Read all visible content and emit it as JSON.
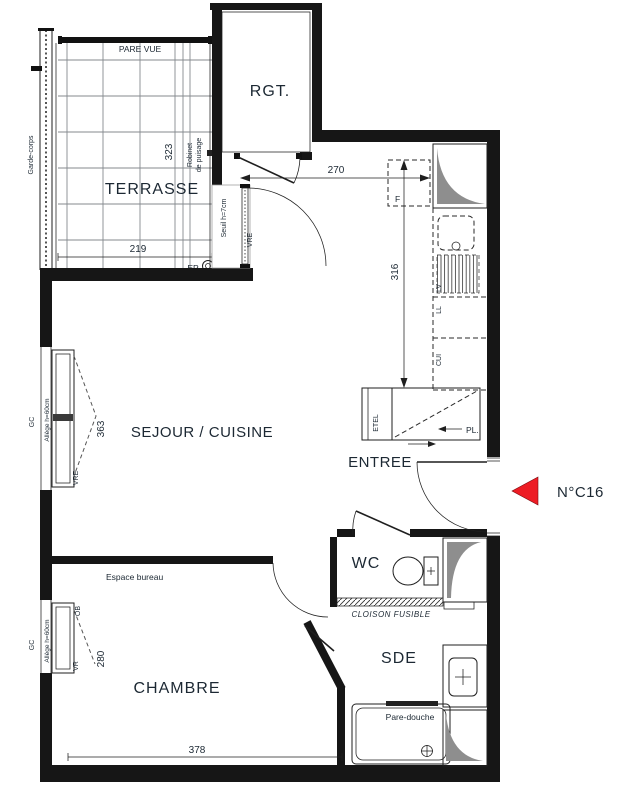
{
  "colors": {
    "wall": "#161616",
    "text": "#1c2833",
    "marker_red": "#ed1c24",
    "duct_gray": "#8e8e8e",
    "grid_gray": "#85898e"
  },
  "unit": {
    "marker_label": "N°C16"
  },
  "rooms": {
    "terrasse": "TERRASSE",
    "rgt": "RGT.",
    "sejour_cuisine": "SEJOUR / CUISINE",
    "entree": "ENTREE",
    "wc": "WC",
    "sde": "SDE",
    "chambre": "CHAMBRE"
  },
  "dimensions_cm": {
    "terrasse_depth": "323",
    "terrasse_width": "219",
    "kitchen_width": "270",
    "kitchen_depth": "316",
    "sejour_window": "363",
    "chambre_window": "280",
    "chambre_width": "378"
  },
  "annotations": {
    "pare_vue": "PARE VUE",
    "garde_corps": "Garde-corps",
    "robinet_line1": "Robinet",
    "robinet_line2": "de puisage",
    "ep": "EP",
    "seuil": "Seuil h=7cm",
    "vre_terrace_door": "VRE",
    "fridge": "F",
    "lave_vaisselle": "LV",
    "lave_linge": "LL",
    "cuisiniere": "CUI",
    "etel": "ETEL",
    "placard": "PL.",
    "gc_sejour": "GC",
    "allege_sejour": "Allège h=60cm",
    "vre_sejour_window": "VRE",
    "espace_bureau": "Espace bureau",
    "gc_chambre": "GC",
    "allege_chambre": "Allège h=60cm",
    "ob_chambre": "OB",
    "vr_chambre": "VR",
    "cloison_fusible": "CLOISON FUSIBLE",
    "pare_douche": "Pare-douche"
  }
}
